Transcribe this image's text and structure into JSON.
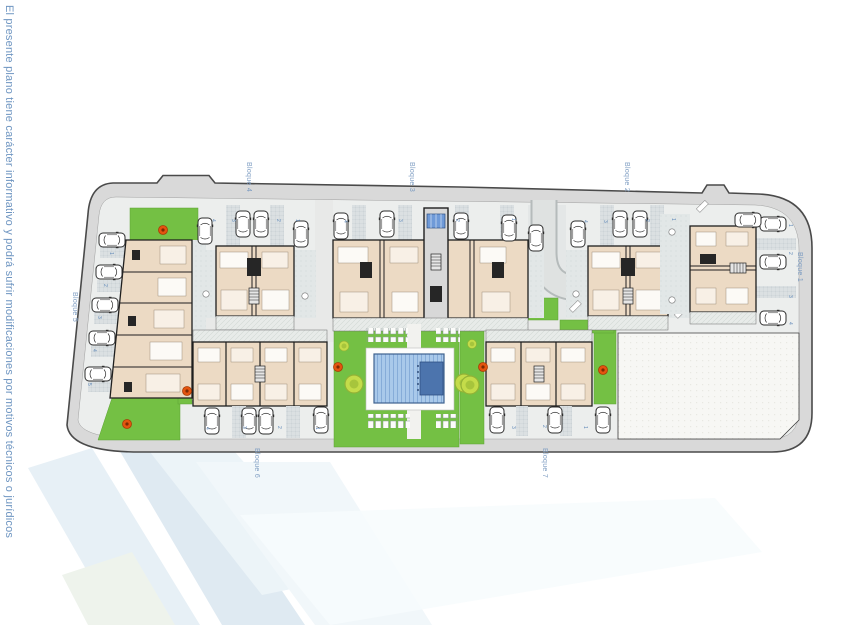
{
  "disclaimer": "El presente plano tiene carácter informativo y podrá sufrir modificaciones por motivos técnicos o jurídicos",
  "blocks": [
    {
      "label": "Bloque 1",
      "units": [
        "1",
        "2",
        "3",
        "4"
      ]
    },
    {
      "label": "Bloque 2",
      "units": [
        "1",
        "2",
        "3",
        "4"
      ]
    },
    {
      "label": "Bloque 3",
      "units": [
        "1",
        "2",
        "3",
        "4"
      ]
    },
    {
      "label": "Bloque 4",
      "units": [
        "1",
        "2",
        "3",
        "4"
      ]
    },
    {
      "label": "Bloque 5",
      "units": [
        "1",
        "2",
        "3",
        "4",
        "5"
      ]
    },
    {
      "label": "Bloque 6",
      "units": [
        "1",
        "2",
        "3",
        "4"
      ]
    },
    {
      "label": "Bloque 7",
      "units": [
        "1",
        "2",
        "3"
      ]
    }
  ],
  "unit_markers": [
    {
      "t": "4",
      "x": 212,
      "y": 219
    },
    {
      "t": "3",
      "x": 232,
      "y": 219
    },
    {
      "t": "2",
      "x": 277,
      "y": 219
    },
    {
      "t": "1",
      "x": 296,
      "y": 219
    },
    {
      "t": "4",
      "x": 344,
      "y": 220
    },
    {
      "t": "3",
      "x": 399,
      "y": 219
    },
    {
      "t": "2",
      "x": 456,
      "y": 219
    },
    {
      "t": "1",
      "x": 512,
      "y": 218
    },
    {
      "t": "4",
      "x": 584,
      "y": 220
    },
    {
      "t": "3",
      "x": 604,
      "y": 220
    },
    {
      "t": "2",
      "x": 646,
      "y": 219
    },
    {
      "t": "1",
      "x": 672,
      "y": 218
    },
    {
      "t": "1",
      "x": 789,
      "y": 224
    },
    {
      "t": "2",
      "x": 789,
      "y": 252
    },
    {
      "t": "3",
      "x": 789,
      "y": 295
    },
    {
      "t": "4",
      "x": 789,
      "y": 322
    },
    {
      "t": "1",
      "x": 110,
      "y": 252
    },
    {
      "t": "2",
      "x": 104,
      "y": 284
    },
    {
      "t": "3",
      "x": 98,
      "y": 316
    },
    {
      "t": "4",
      "x": 93,
      "y": 349
    },
    {
      "t": "5",
      "x": 88,
      "y": 383
    },
    {
      "t": "4",
      "x": 206,
      "y": 427
    },
    {
      "t": "3",
      "x": 243,
      "y": 426
    },
    {
      "t": "2",
      "x": 278,
      "y": 426
    },
    {
      "t": "1",
      "x": 316,
      "y": 427
    },
    {
      "t": "3",
      "x": 512,
      "y": 426
    },
    {
      "t": "2",
      "x": 543,
      "y": 425
    },
    {
      "t": "1",
      "x": 584,
      "y": 426
    }
  ],
  "colors": {
    "label_blue": "#7e9dc2",
    "disclaimer_blue": "#6e95c1",
    "grass": "#74c044",
    "pool_water": "#a9c9ea",
    "pool_deep": "#4c74ad",
    "building": "#ecdac4",
    "tree_red": "#e4540f",
    "tree_lime": "#c4dc4a",
    "street": "#eceaction",
    "boundary_band": "#d9d9d9"
  }
}
